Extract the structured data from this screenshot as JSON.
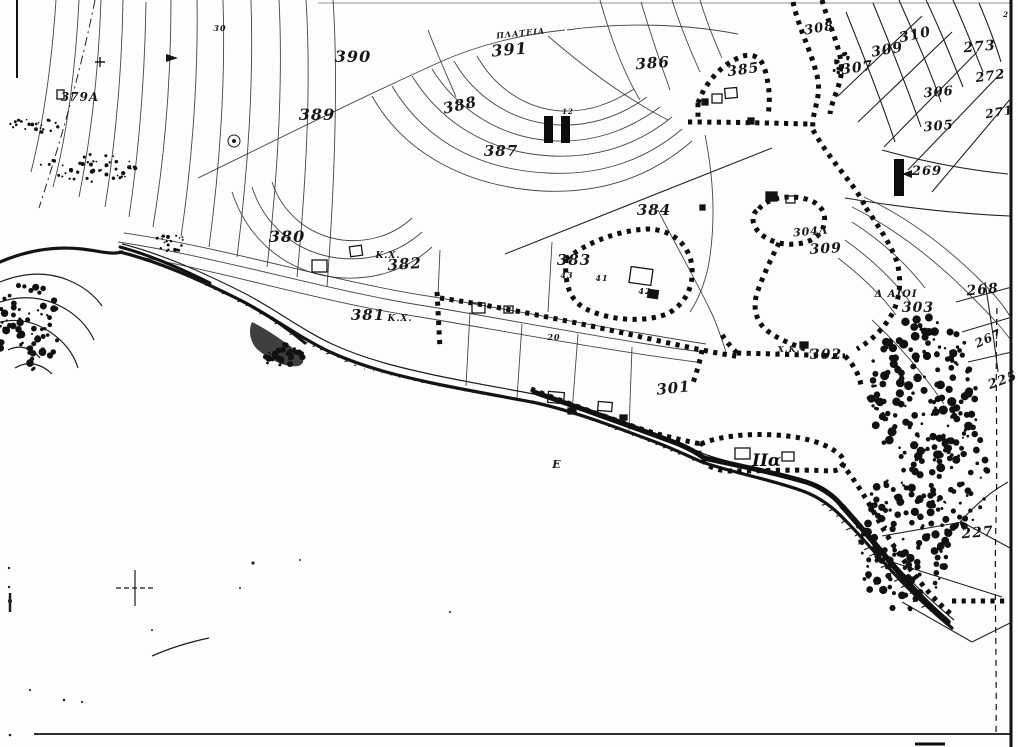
{
  "meta": {
    "description": "Scanned black-and-white cadastral / topographic map sheet of a coastal settlement with contour lines, dotted zone boundaries, parcel numbers and shoreline rocks",
    "paper_color": "#fdfdfb",
    "ink_color": "#1c1c1c"
  },
  "map": {
    "labels": [
      {
        "text": "390",
        "x": 353,
        "y": 62,
        "fs": 16,
        "rot": 0
      },
      {
        "text": "391",
        "x": 510,
        "y": 55,
        "fs": 16,
        "rot": -5
      },
      {
        "text": "ΠΛΑΤΕΙΑ",
        "x": 521,
        "y": 36,
        "fs": 8,
        "rot": -6
      },
      {
        "text": "389",
        "x": 317,
        "y": 120,
        "fs": 16,
        "rot": 0
      },
      {
        "text": "388",
        "x": 461,
        "y": 110,
        "fs": 15,
        "rot": -12
      },
      {
        "text": "387",
        "x": 501,
        "y": 156,
        "fs": 15,
        "rot": 0
      },
      {
        "text": "386",
        "x": 653,
        "y": 68,
        "fs": 15,
        "rot": -4
      },
      {
        "text": "385",
        "x": 744,
        "y": 74,
        "fs": 14,
        "rot": -8
      },
      {
        "text": "379A",
        "x": 80,
        "y": 101,
        "fs": 12,
        "rot": 0
      },
      {
        "text": "380",
        "x": 287,
        "y": 242,
        "fs": 16,
        "rot": 0
      },
      {
        "text": "K.X.",
        "x": 388,
        "y": 258,
        "fs": 9,
        "rot": 0
      },
      {
        "text": "382",
        "x": 405,
        "y": 269,
        "fs": 15,
        "rot": -4
      },
      {
        "text": "381",
        "x": 368,
        "y": 320,
        "fs": 15,
        "rot": 0
      },
      {
        "text": "K.X.",
        "x": 400,
        "y": 321,
        "fs": 9,
        "rot": 0
      },
      {
        "text": "383",
        "x": 574,
        "y": 265,
        "fs": 15,
        "rot": 0
      },
      {
        "text": "43",
        "x": 567,
        "y": 278,
        "fs": 8,
        "rot": 0
      },
      {
        "text": "41",
        "x": 602,
        "y": 281,
        "fs": 8,
        "rot": 0
      },
      {
        "text": "42",
        "x": 645,
        "y": 294,
        "fs": 8,
        "rot": 0
      },
      {
        "text": "384",
        "x": 654,
        "y": 215,
        "fs": 15,
        "rot": 0
      },
      {
        "text": "301",
        "x": 674,
        "y": 393,
        "fs": 15,
        "rot": -6
      },
      {
        "text": "302",
        "x": 826,
        "y": 359,
        "fs": 14,
        "rot": 0
      },
      {
        "text": "Χ.Κ.",
        "x": 789,
        "y": 352,
        "fs": 8,
        "rot": 0
      },
      {
        "text": "303",
        "x": 918,
        "y": 312,
        "fs": 14,
        "rot": 0
      },
      {
        "text": "Δ ΑΙΟΙ",
        "x": 896,
        "y": 297,
        "fs": 10,
        "rot": 0
      },
      {
        "text": "304Λ",
        "x": 811,
        "y": 235,
        "fs": 11,
        "rot": -5
      },
      {
        "text": "309",
        "x": 826,
        "y": 253,
        "fs": 14,
        "rot": -3
      },
      {
        "text": "268",
        "x": 983,
        "y": 294,
        "fs": 14,
        "rot": -5
      },
      {
        "text": "267",
        "x": 990,
        "y": 342,
        "fs": 12,
        "rot": -25
      },
      {
        "text": "225",
        "x": 1004,
        "y": 384,
        "fs": 13,
        "rot": -20
      },
      {
        "text": "227",
        "x": 978,
        "y": 537,
        "fs": 14,
        "rot": -5
      },
      {
        "text": "269",
        "x": 927,
        "y": 175,
        "fs": 13,
        "rot": 0
      },
      {
        "text": "305",
        "x": 939,
        "y": 130,
        "fs": 13,
        "rot": -5
      },
      {
        "text": "306",
        "x": 939,
        "y": 96,
        "fs": 13,
        "rot": -5
      },
      {
        "text": "271",
        "x": 1000,
        "y": 116,
        "fs": 12,
        "rot": -10
      },
      {
        "text": "272",
        "x": 991,
        "y": 80,
        "fs": 13,
        "rot": -8
      },
      {
        "text": "273",
        "x": 980,
        "y": 51,
        "fs": 14,
        "rot": -5
      },
      {
        "text": "307",
        "x": 858,
        "y": 72,
        "fs": 14,
        "rot": -8
      },
      {
        "text": "309",
        "x": 888,
        "y": 54,
        "fs": 14,
        "rot": -10
      },
      {
        "text": "310",
        "x": 916,
        "y": 39,
        "fs": 14,
        "rot": -12
      },
      {
        "text": "308",
        "x": 820,
        "y": 32,
        "fs": 13,
        "rot": -10
      },
      {
        "text": "E",
        "x": 557,
        "y": 468,
        "fs": 11,
        "rot": 0
      },
      {
        "text": "30",
        "x": 220,
        "y": 31,
        "fs": 8,
        "rot": 0
      },
      {
        "text": "12",
        "x": 568,
        "y": 114,
        "fs": 7,
        "rot": 0
      },
      {
        "text": "20",
        "x": 554,
        "y": 340,
        "fs": 8,
        "rot": 0
      },
      {
        "text": "21",
        "x": 1009,
        "y": 17,
        "fs": 7,
        "rot": 0
      }
    ],
    "zone_markers": [
      {
        "label": "II",
        "x": 544,
        "y": 116,
        "style": "bars",
        "bar_w": 9,
        "bar_h": 27,
        "gap": 8
      },
      {
        "label": "I",
        "x": 894,
        "y": 159,
        "style": "bars",
        "bar_w": 10,
        "bar_h": 37,
        "gap": 0
      },
      {
        "label": "IIα",
        "x": 752,
        "y": 466,
        "style": "text",
        "fs": 17
      }
    ]
  }
}
